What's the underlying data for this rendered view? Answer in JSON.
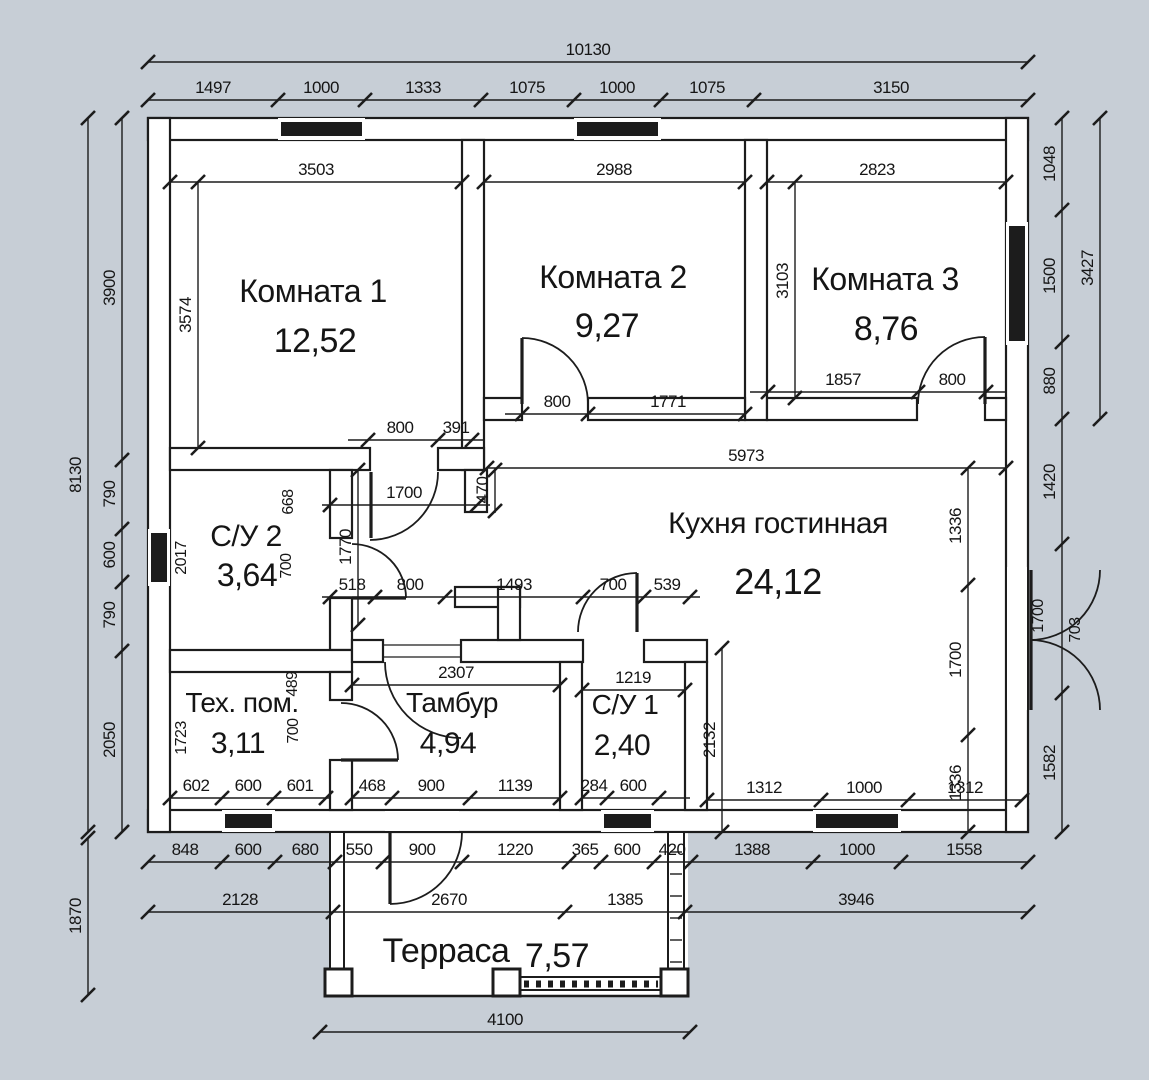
{
  "title": "План этажа",
  "colors": {
    "background": "#c7ced6",
    "paper": "#ffffff",
    "line": "#1c1c1c",
    "dim_text": "#1f1f1f"
  },
  "rooms": [
    {
      "name": "Комната 1",
      "area": "12,52",
      "nx": 313,
      "ny": 302,
      "ax": 315,
      "ay": 352,
      "nfs": 32,
      "afs": 34
    },
    {
      "name": "Комната 2",
      "area": "9,27",
      "nx": 613,
      "ny": 288,
      "ax": 607,
      "ay": 337,
      "nfs": 32,
      "afs": 34
    },
    {
      "name": "Комната 3",
      "area": "8,76",
      "nx": 885,
      "ny": 290,
      "ax": 886,
      "ay": 340,
      "nfs": 32,
      "afs": 34
    },
    {
      "name": "С/У 2",
      "area": "3,64",
      "nx": 246,
      "ny": 546,
      "ax": 247,
      "ay": 586,
      "nfs": 30,
      "afs": 32
    },
    {
      "name": "Кухня гостинная",
      "area": "24,12",
      "nx": 778,
      "ny": 533,
      "ax": 778,
      "ay": 594,
      "nfs": 30,
      "afs": 36
    },
    {
      "name": "Тех. пом.",
      "area": "3,11",
      "nx": 242,
      "ny": 712,
      "ax": 238,
      "ay": 753,
      "nfs": 28,
      "afs": 30
    },
    {
      "name": "Тамбур",
      "area": "4,94",
      "nx": 452,
      "ny": 712,
      "ax": 448,
      "ay": 753,
      "nfs": 28,
      "afs": 30
    },
    {
      "name": "С/У 1",
      "area": "2,40",
      "nx": 625,
      "ny": 714,
      "ax": 622,
      "ay": 755,
      "nfs": 28,
      "afs": 30
    },
    {
      "name": "Терраса",
      "area": "7,57",
      "nx": 446,
      "ny": 962,
      "ax": 557,
      "ay": 967,
      "nfs": 34,
      "afs": 34
    }
  ],
  "dimensions": {
    "chains_h": [
      {
        "pos": 62,
        "s": 148,
        "e": 1028,
        "ticks": [
          148,
          1028
        ],
        "labels": [
          {
            "t": "10130",
            "at": 588
          }
        ]
      },
      {
        "pos": 100,
        "s": 148,
        "e": 1028,
        "ticks": [
          148,
          278,
          365,
          481,
          574,
          661,
          754,
          1028
        ],
        "labels": [
          {
            "t": "1497",
            "at": 213
          },
          {
            "t": "1000",
            "at": 321
          },
          {
            "t": "1333",
            "at": 423
          },
          {
            "t": "1075",
            "at": 527
          },
          {
            "t": "1000",
            "at": 617
          },
          {
            "t": "1075",
            "at": 707
          },
          {
            "t": "3150",
            "at": 891
          }
        ]
      },
      {
        "pos": 182,
        "s": 170,
        "e": 462,
        "ticks": [
          170,
          462
        ],
        "labels": [
          {
            "t": "3503",
            "at": 316
          }
        ]
      },
      {
        "pos": 182,
        "s": 484,
        "e": 745,
        "ticks": [
          484,
          745
        ],
        "labels": [
          {
            "t": "2988",
            "at": 614
          }
        ]
      },
      {
        "pos": 182,
        "s": 767,
        "e": 1006,
        "ticks": [
          767,
          1006
        ],
        "labels": [
          {
            "t": "2823",
            "at": 877
          }
        ]
      },
      {
        "pos": 440,
        "s": 348,
        "e": 484,
        "ticks": [
          368,
          438,
          472
        ],
        "labels": [
          {
            "t": "800",
            "at": 400
          },
          {
            "t": "391",
            "at": 456
          }
        ]
      },
      {
        "pos": 414,
        "s": 505,
        "e": 745,
        "ticks": [
          522,
          588,
          745
        ],
        "labels": [
          {
            "t": "800",
            "at": 557
          },
          {
            "t": "1771",
            "at": 668
          }
        ]
      },
      {
        "pos": 392,
        "s": 750,
        "e": 1006,
        "ticks": [
          768,
          918,
          986
        ],
        "labels": [
          {
            "t": "1857",
            "at": 843
          },
          {
            "t": "800",
            "at": 952
          }
        ]
      },
      {
        "pos": 468,
        "s": 487,
        "e": 1006,
        "ticks": [
          487,
          1006
        ],
        "labels": [
          {
            "t": "5973",
            "at": 746
          }
        ]
      },
      {
        "pos": 505,
        "s": 322,
        "e": 490,
        "ticks": [
          330,
          477
        ],
        "labels": [
          {
            "t": "1700",
            "at": 404
          }
        ]
      },
      {
        "pos": 597,
        "s": 322,
        "e": 700,
        "ticks": [
          330,
          375,
          445,
          583,
          644,
          690
        ],
        "labels": [
          {
            "t": "518",
            "at": 352
          },
          {
            "t": "800",
            "at": 410
          },
          {
            "t": "1493",
            "at": 514
          },
          {
            "t": "700",
            "at": 613
          },
          {
            "t": "539",
            "at": 667
          }
        ]
      },
      {
        "pos": 685,
        "s": 352,
        "e": 560,
        "ticks": [
          352,
          560
        ],
        "labels": [
          {
            "t": "2307",
            "at": 456
          }
        ]
      },
      {
        "pos": 690,
        "s": 582,
        "e": 685,
        "ticks": [
          582,
          685
        ],
        "labels": [
          {
            "t": "1219",
            "at": 633
          }
        ]
      },
      {
        "pos": 798,
        "s": 170,
        "e": 330,
        "ticks": [
          170,
          222,
          274,
          326
        ],
        "labels": [
          {
            "t": "602",
            "at": 196
          },
          {
            "t": "600",
            "at": 248
          },
          {
            "t": "601",
            "at": 300
          }
        ]
      },
      {
        "pos": 798,
        "s": 352,
        "e": 560,
        "ticks": [
          352,
          392,
          470,
          560
        ],
        "labels": [
          {
            "t": "468",
            "at": 372
          },
          {
            "t": "900",
            "at": 431
          },
          {
            "t": "1139",
            "at": 515
          }
        ]
      },
      {
        "pos": 798,
        "s": 582,
        "e": 690,
        "ticks": [
          582,
          607,
          659
        ],
        "labels": [
          {
            "t": "284",
            "at": 594
          },
          {
            "t": "600",
            "at": 633
          }
        ]
      },
      {
        "pos": 800,
        "s": 707,
        "e": 1022,
        "ticks": [
          707,
          821,
          908,
          1022
        ],
        "labels": [
          {
            "t": "1312",
            "at": 764
          },
          {
            "t": "1000",
            "at": 864
          },
          {
            "t": "1312",
            "at": 965
          }
        ]
      },
      {
        "pos": 862,
        "s": 148,
        "e": 1028,
        "ticks": [
          148,
          222,
          275,
          335,
          383,
          462,
          569,
          601,
          654,
          691,
          813,
          901,
          1028
        ],
        "labels": [
          {
            "t": "848",
            "at": 185
          },
          {
            "t": "600",
            "at": 248
          },
          {
            "t": "680",
            "at": 305
          },
          {
            "t": "550",
            "at": 359
          },
          {
            "t": "900",
            "at": 422
          },
          {
            "t": "1220",
            "at": 515
          },
          {
            "t": "365",
            "at": 585
          },
          {
            "t": "600",
            "at": 627
          },
          {
            "t": "420",
            "at": 672
          },
          {
            "t": "1388",
            "at": 752
          },
          {
            "t": "1000",
            "at": 857
          },
          {
            "t": "1558",
            "at": 964
          }
        ]
      },
      {
        "pos": 912,
        "s": 148,
        "e": 1028,
        "ticks": [
          148,
          333,
          565,
          685,
          1028
        ],
        "labels": [
          {
            "t": "2128",
            "at": 240
          },
          {
            "t": "2670",
            "at": 449
          },
          {
            "t": "1385",
            "at": 625
          },
          {
            "t": "3946",
            "at": 856
          }
        ]
      },
      {
        "pos": 1032,
        "s": 320,
        "e": 690,
        "ticks": [
          320,
          690
        ],
        "labels": [
          {
            "t": "4100",
            "at": 505
          }
        ]
      }
    ],
    "chains_v": [
      {
        "pos": 88,
        "s": 118,
        "e": 832,
        "ticks": [
          118,
          832
        ],
        "labels": [
          {
            "t": "8130",
            "at": 475
          }
        ]
      },
      {
        "pos": 122,
        "s": 118,
        "e": 832,
        "ticks": [
          118,
          460,
          529,
          582,
          651,
          832
        ],
        "labels": [
          {
            "t": "3900",
            "at": 288
          },
          {
            "t": "790",
            "at": 494
          },
          {
            "t": "600",
            "at": 555
          },
          {
            "t": "790",
            "at": 615
          },
          {
            "t": "2050",
            "at": 740
          }
        ]
      },
      {
        "pos": 88,
        "s": 838,
        "e": 995,
        "ticks": [
          838,
          995
        ],
        "labels": [
          {
            "t": "1870",
            "at": 916
          }
        ]
      },
      {
        "pos": 198,
        "s": 182,
        "e": 448,
        "ticks": [
          182,
          448
        ],
        "labels": [
          {
            "t": "3574",
            "at": 315
          }
        ]
      },
      {
        "pos": 795,
        "s": 182,
        "e": 398,
        "ticks": [
          182,
          398
        ],
        "labels": [
          {
            "t": "3103",
            "at": 281
          }
        ]
      },
      {
        "pos": 1062,
        "s": 118,
        "e": 832,
        "ticks": [
          118,
          210,
          342,
          419,
          544,
          693,
          832
        ],
        "labels": [
          {
            "t": "1048",
            "at": 164
          },
          {
            "t": "1500",
            "at": 276
          },
          {
            "t": "880",
            "at": 381
          },
          {
            "t": "1420",
            "at": 482
          },
          {
            "t": "1582",
            "at": 763
          }
        ]
      },
      {
        "pos": 1100,
        "s": 118,
        "e": 419,
        "ticks": [
          118,
          419
        ],
        "labels": [
          {
            "t": "3427",
            "at": 268
          }
        ]
      },
      {
        "pos": 968,
        "s": 468,
        "e": 832,
        "ticks": [
          468,
          585,
          735,
          832
        ],
        "labels": [
          {
            "t": "1336",
            "at": 526
          },
          {
            "t": "1700",
            "at": 660
          },
          {
            "t": "1336",
            "at": 783
          }
        ]
      },
      {
        "pos": 722,
        "s": 648,
        "e": 832,
        "ticks": [
          648,
          832
        ],
        "labels": [
          {
            "t": "2132",
            "at": 740
          }
        ]
      },
      {
        "pos": 495,
        "s": 468,
        "e": 513,
        "ticks": [
          470,
          511
        ],
        "labels": [
          {
            "t": "470",
            "at": 490
          }
        ]
      },
      {
        "pos": 358,
        "s": 470,
        "e": 625,
        "ticks": [
          470,
          625
        ],
        "labels": [
          {
            "t": "1770",
            "at": 547
          }
        ]
      }
    ],
    "free_labels_v": [
      {
        "t": "2017",
        "x": 186,
        "y": 558
      },
      {
        "t": "668",
        "x": 293,
        "y": 502
      },
      {
        "t": "700",
        "x": 291,
        "y": 566
      },
      {
        "t": "489",
        "x": 297,
        "y": 684
      },
      {
        "t": "700",
        "x": 298,
        "y": 731
      },
      {
        "t": "1723",
        "x": 186,
        "y": 738
      },
      {
        "t": "1700",
        "x": 1043,
        "y": 616
      },
      {
        "t": "703",
        "x": 1080,
        "y": 630
      }
    ]
  },
  "drawing": {
    "canvas": [
      1149,
      1080
    ],
    "interior": [
      148,
      118,
      880,
      714
    ],
    "terrace_rect": [
      330,
      832,
      358,
      164
    ],
    "walls": [
      [
        148,
        118,
        880,
        22
      ],
      [
        148,
        810,
        880,
        22
      ],
      [
        148,
        118,
        22,
        714
      ],
      [
        1006,
        118,
        22,
        714
      ],
      [
        462,
        140,
        22,
        330
      ],
      [
        170,
        448,
        200,
        22
      ],
      [
        438,
        448,
        46,
        22
      ],
      [
        745,
        140,
        22,
        280
      ],
      [
        484,
        398,
        38,
        22
      ],
      [
        588,
        398,
        157,
        22
      ],
      [
        767,
        398,
        150,
        22
      ],
      [
        985,
        398,
        21,
        22
      ],
      [
        330,
        470,
        22,
        68
      ],
      [
        330,
        598,
        22,
        52
      ],
      [
        170,
        650,
        182,
        22
      ],
      [
        330,
        672,
        22,
        28
      ],
      [
        330,
        760,
        22,
        50
      ],
      [
        352,
        640,
        31,
        22
      ],
      [
        461,
        640,
        122,
        22
      ],
      [
        644,
        640,
        63,
        22
      ],
      [
        560,
        662,
        22,
        148
      ],
      [
        685,
        662,
        22,
        148
      ],
      [
        465,
        470,
        22,
        42
      ],
      [
        455,
        587,
        65,
        20
      ],
      [
        498,
        587,
        22,
        53
      ]
    ],
    "gaps": [
      [
        385,
        811,
        74,
        20
      ],
      [
        1007,
        567,
        20,
        143
      ]
    ],
    "windows": [
      [
        278,
        118,
        87,
        22,
        "h"
      ],
      [
        574,
        118,
        87,
        22,
        "h"
      ],
      [
        1006,
        222,
        22,
        123,
        "v"
      ],
      [
        148,
        529,
        22,
        57,
        "v"
      ],
      [
        222,
        810,
        53,
        22,
        "h"
      ],
      [
        601,
        810,
        53,
        22,
        "h"
      ],
      [
        813,
        810,
        88,
        22,
        "h"
      ]
    ],
    "door_arcs": [
      "M438,472 A68,68 0 0 1 370,540",
      "M522,338 A66,66 0 0 1 588,404",
      "M985,337 A67,67 0 0 0 918,404",
      "M406,598 A54,54 0 0 0 352,544",
      "M398,760 A57,57 0 0 0 341,703",
      "M637,573 A59,59 0 0 0 578,632",
      "M385,662 A76,76 0 0 0 461,738",
      "M390,904 A72,72 0 0 0 462,832",
      "M1100,570 A70,70 0 0 1 1030,640",
      "M1100,710 A70,70 0 0 0 1030,640"
    ],
    "door_leaves": [
      [
        371,
        472,
        371,
        538
      ],
      [
        522,
        404,
        522,
        338
      ],
      [
        985,
        404,
        985,
        337
      ],
      [
        352,
        598,
        406,
        598
      ],
      [
        341,
        760,
        398,
        760
      ],
      [
        637,
        632,
        637,
        573
      ],
      [
        390,
        832,
        390,
        904
      ],
      [
        1031,
        570,
        1031,
        640
      ],
      [
        1031,
        640,
        1031,
        710
      ]
    ],
    "thin_lines": [
      [
        383,
        645,
        461,
        645
      ],
      [
        383,
        657,
        461,
        657
      ]
    ],
    "terrace": {
      "left_border": [
        330,
        832,
        14,
        164
      ],
      "right_border": [
        668,
        832,
        16,
        164
      ],
      "bottom_line": [
        330,
        996,
        684,
        996
      ],
      "posts": [
        [
          325,
          969,
          27,
          27
        ],
        [
          493,
          969,
          27,
          27
        ],
        [
          661,
          969,
          27,
          27
        ]
      ],
      "rail_top": [
        520,
        977,
        661,
        977
      ],
      "rail_bot": [
        520,
        990,
        661,
        990
      ],
      "rail_dash": [
        524,
        984,
        658,
        984
      ],
      "rungs_y": [
        852,
        874,
        896,
        918,
        940,
        962
      ],
      "rungs_x": [
        670,
        682
      ]
    }
  }
}
